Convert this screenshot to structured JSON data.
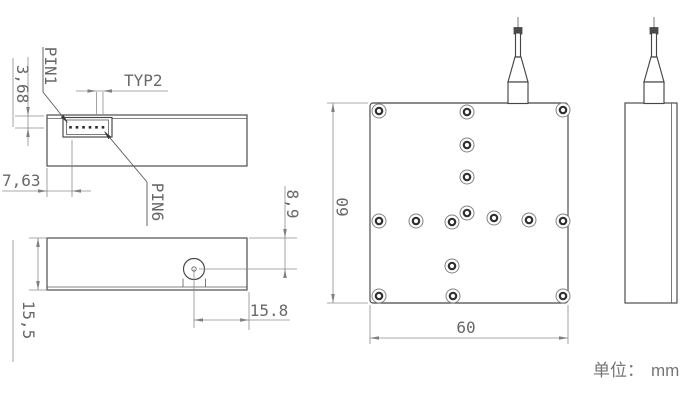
{
  "unit_note": {
    "label": "单位：",
    "value": "mm"
  },
  "views": {
    "side_top": {
      "name": "side-view-connector-side",
      "labels": {
        "pin1": "PIN1",
        "pin6": "PIN6"
      },
      "dims": {
        "pin_pitch": "TYP2",
        "pin_row_offset_from_top": "3,68",
        "pin1_offset_from_left": "7,63"
      }
    },
    "side_bottom": {
      "name": "side-view-fiber-side",
      "dims": {
        "fiber_axis_from_top": "8,9",
        "body_height": "15,5",
        "fiber_axis_from_right": "15.8"
      }
    },
    "plan": {
      "name": "top-view",
      "dims": {
        "body_width": "60",
        "body_depth": "60"
      },
      "screw_holes": [
        [
          379,
          111
        ],
        [
          467,
          112
        ],
        [
          563,
          110
        ],
        [
          467,
          145
        ],
        [
          467,
          177
        ],
        [
          467,
          213
        ],
        [
          379,
          221
        ],
        [
          416,
          221
        ],
        [
          452,
          222
        ],
        [
          494,
          218
        ],
        [
          529,
          220
        ],
        [
          563,
          221
        ],
        [
          452,
          266
        ],
        [
          379,
          296
        ],
        [
          453,
          296
        ],
        [
          563,
          296
        ]
      ]
    },
    "side_right": {
      "name": "right-side-view"
    }
  }
}
